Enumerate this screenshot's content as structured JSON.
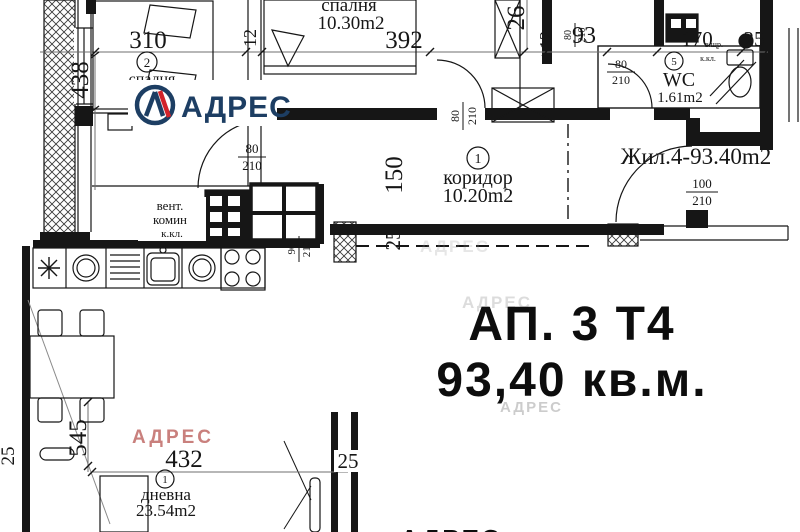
{
  "colors": {
    "ink": "#161616",
    "logo_navy": "#1d3e63",
    "logo_red": "#d2232a",
    "watermark_pink": "#c9807d"
  },
  "logo": {
    "brand": "АДРЕС"
  },
  "watermark": {
    "brand": "АДРЕС"
  },
  "title": {
    "line1": "АП. 3 Т4",
    "line2": "93,40 кв.м."
  },
  "unit": {
    "label": "Жил.4-93.40m2"
  },
  "rooms": {
    "bedroom1": {
      "num": "2",
      "name": "спалня",
      "area": "13.2"
    },
    "bedroom2": {
      "name": "спалня",
      "area": "10.30m2"
    },
    "corridor": {
      "num": "1",
      "name": "коридор",
      "area": "10.20m2"
    },
    "wc": {
      "num": "5",
      "name": "WC",
      "area": "1.61m2"
    },
    "living": {
      "num": "1",
      "name": "дневна",
      "area": "23.54m2"
    }
  },
  "vent": {
    "l1": "вент.",
    "l2": "комин",
    "l3": "к.кл."
  },
  "shaft": {
    "l1": "в.щр.",
    "l2": "к.кл."
  },
  "dims": {
    "w310": "310",
    "h438": "438",
    "w392": "392",
    "h26": "26",
    "t12": "12",
    "w93": "93",
    "w170": "170",
    "w25_top": "25",
    "h150": "150",
    "t25_mid": "25",
    "h545": "545",
    "w432": "432",
    "t25_bottom": "25",
    "t25_left": "25"
  },
  "doors": {
    "w80": "80",
    "w90": "90",
    "w100": "100",
    "h210": "210"
  }
}
